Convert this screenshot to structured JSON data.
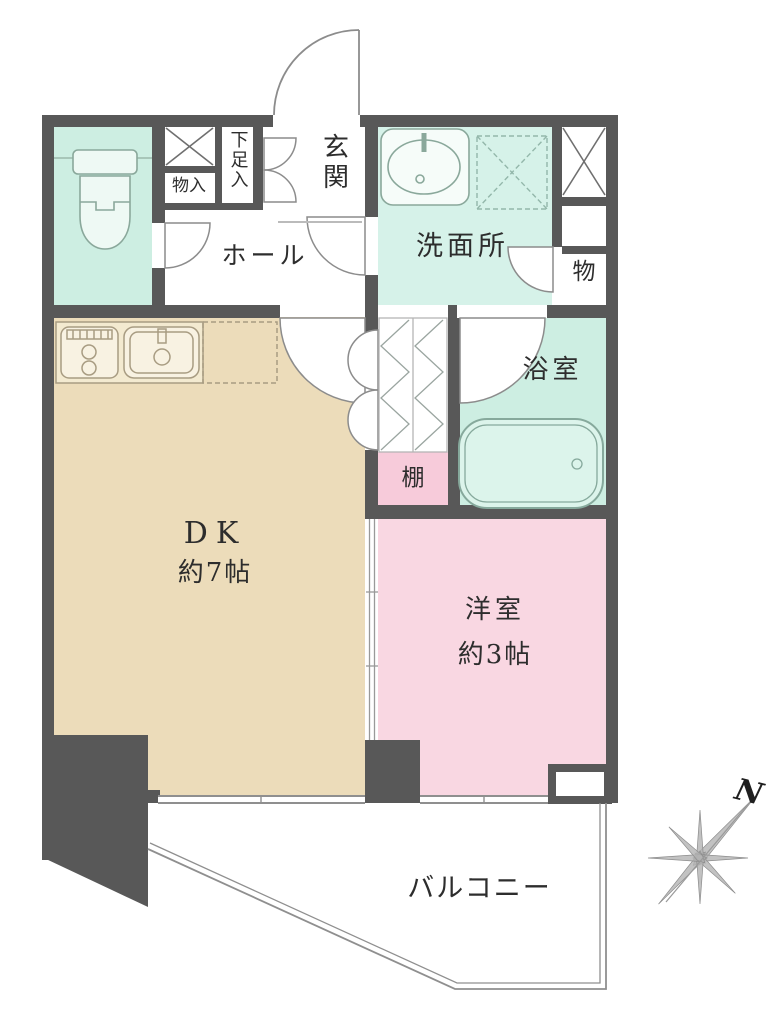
{
  "plan": {
    "compass": "N",
    "rooms": {
      "genkan": "玄関",
      "hall": "ホール",
      "shoe_cabinet": "下足入",
      "storage_closet": "物入",
      "washroom": "洗面所",
      "storage": "物",
      "bathroom": "浴室",
      "shelf": "棚",
      "dk": "DK",
      "dk_size": "約7帖",
      "western_room": "洋室",
      "western_size": "約3帖",
      "balcony": "バルコニー"
    },
    "colors": {
      "wall": "#585858",
      "toilet_floor": "#cdeee2",
      "washroom_floor": "#d6f2e9",
      "bathroom_floor": "#cdeee2",
      "dk_floor": "#ecdcba",
      "western_floor": "#f9d7e2",
      "shelf_fill": "#f7cbda"
    }
  }
}
